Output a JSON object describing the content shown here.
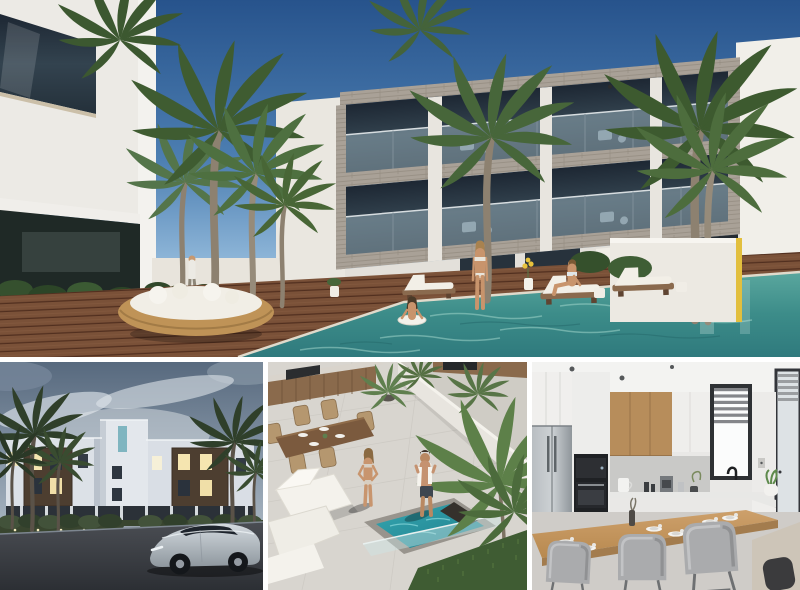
{
  "page": {
    "background_color": "#ffffff",
    "kind": "real-estate photo collage, four architectural renderings, no visible text"
  },
  "collage": {
    "gap_px": 5,
    "panels": [
      {
        "name": "main-exterior-pool",
        "position": "top full-width",
        "alt": "Modern three-storey white apartment building with stone-clad balconies, tall palm trees, wooden sun deck, round rattan daybed, sun loungers and turquoise swimming pool with people"
      },
      {
        "name": "street-view-dusk",
        "position": "bottom-left",
        "alt": "White apartment complex at dusk with dark wood window panels, lit windows, palm trees, illuminated hedge and a silver car on the road"
      },
      {
        "name": "rooftop-terrace",
        "position": "bottom-middle",
        "alt": "Rooftop terrace seen from above with outdoor kitchen, wooden dining set, white loungers, turquoise plunge pool, palm fronds and a standing couple"
      },
      {
        "name": "kitchen-interior",
        "position": "bottom-right",
        "alt": "Modern kitchen with white and wood cabinets, stainless fridge, built-in ovens, window with zebra blinds, wooden breakfast bar with place settings and grey stools"
      }
    ]
  },
  "palette": {
    "sky_blue_top": "#27538c",
    "sky_blue_horizon": "#d9e9f2",
    "pool_teal": "#3c8c89",
    "deck_wood": "#7a5138",
    "building_white": "#edebe5",
    "stone_cladding": "#a9a197",
    "glass_dark": "#27313d",
    "palm_green": "#4f6f41",
    "accent_yellow": "#e2bf3e",
    "dusk_sky": "#8494a3",
    "night_window_glow": "#f5e5b0",
    "terrace_pool_teal": "#2a97a3",
    "kitchen_wood": "#b78d5b",
    "stool_grey": "#aaabad"
  }
}
